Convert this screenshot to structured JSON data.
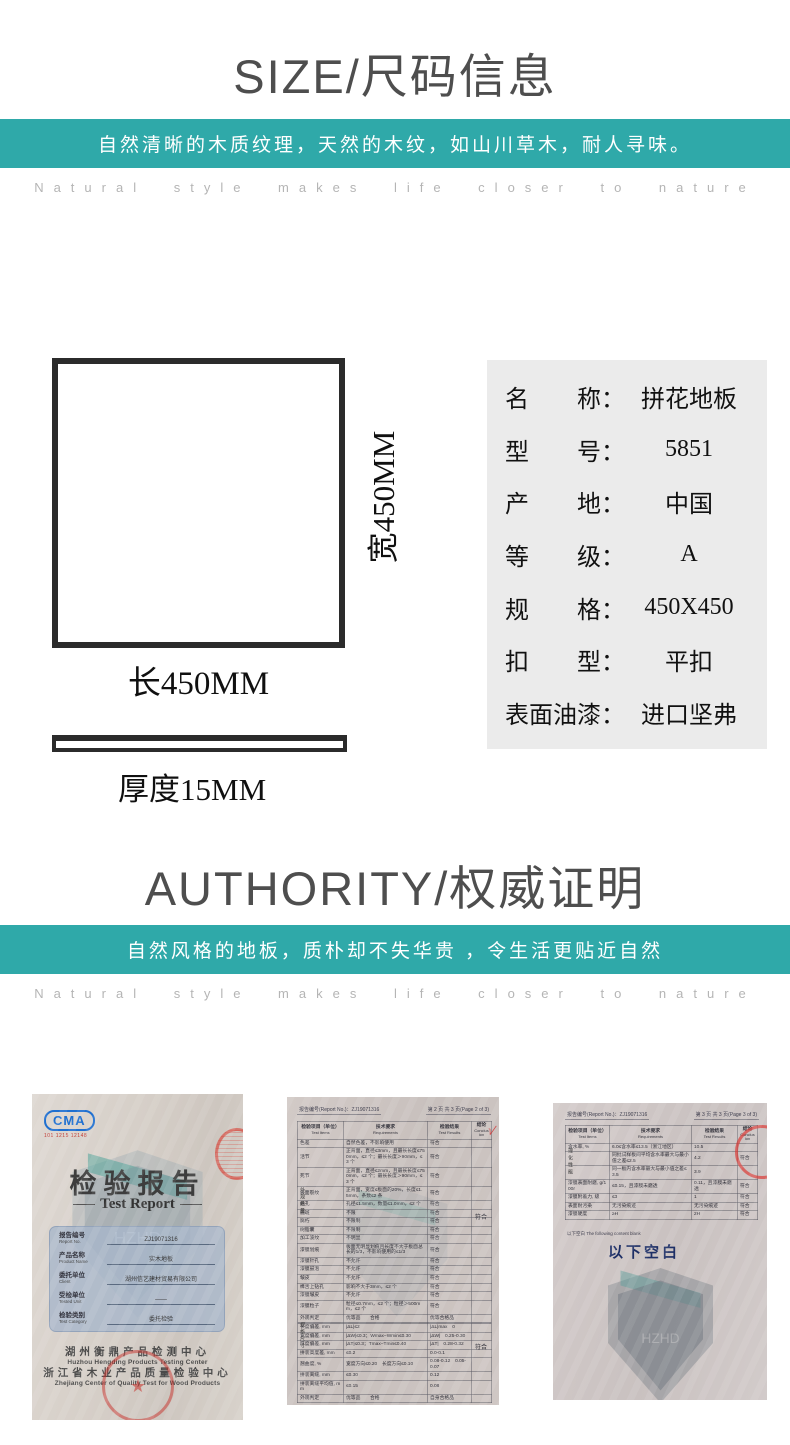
{
  "colors": {
    "accent_teal": "#2fa9a9",
    "paper": "#d2cac6",
    "cert_blue_box": "#a8b6ca"
  },
  "size_section": {
    "title": "SIZE/尺码信息",
    "banner_text": "自然清晰的木质纹理，天然的木纹，如山川草木，耐人寻味。",
    "subtitle": "Natural style makes life closer to nature"
  },
  "diagram": {
    "width_label": "宽450MM",
    "length_label": "长450MM",
    "thickness_label": "厚度15MM"
  },
  "specs": {
    "colon": "：",
    "rows": [
      {
        "label": "名　　称",
        "value": "拼花地板"
      },
      {
        "label": "型　　号",
        "value": "5851"
      },
      {
        "label": "产　　地",
        "value": "中国"
      },
      {
        "label": "等　　级",
        "value": "A"
      },
      {
        "label": "规　　格",
        "value": "450X450"
      },
      {
        "label": "扣　　型",
        "value": "平扣"
      },
      {
        "label": "表面油漆",
        "value": "进口坚弗"
      }
    ]
  },
  "authority_section": {
    "title": "AUTHORITY/权威证明",
    "banner_text": "自然风格的地板，质朴却不失华贵 ，令生活更贴近自然",
    "subtitle": "Natural style makes life closer to nature"
  },
  "certificates": {
    "table_headers": [
      {
        "cn": "检验项目（单位）",
        "en": "Test Items"
      },
      {
        "cn": "技术要求",
        "en": "Requirements"
      },
      {
        "cn": "检验结果",
        "en": "Test Results"
      },
      {
        "cn": "结论",
        "en": "Conclusion"
      }
    ],
    "cert1": {
      "cma_label": "CMA",
      "cma_sub": "101 1215 12148",
      "title": "检验报告",
      "subtitle": "Test Report",
      "watermark": "HZHD",
      "stamp_star": "★",
      "fields": [
        {
          "cn": "报告编号",
          "en": "Report No.",
          "value": "ZJ19071316"
        },
        {
          "cn": "产品名称",
          "en": "Product Name",
          "value": "实木地板"
        },
        {
          "cn": "委托单位",
          "en": "Client",
          "value": "湖州信艺建材贸易有限公司"
        },
        {
          "cn": "受检单位",
          "en": "Tested Unit",
          "value": "——"
        },
        {
          "cn": "检验类别",
          "en": "Test Category",
          "value": "委托检验"
        }
      ],
      "org_lines": [
        "湖州衡鼎产品检测中心",
        "Huzhou Hengding Products Testing Center",
        "浙江省木业产品质量检验中心",
        "Zhejiang Center of Quality Test for Wood Products"
      ]
    },
    "cert2": {
      "report_no": "报告编号(Report No.)：ZJ19071316",
      "page_info": "第 2 页 共 3 页(Page 2 of 3)",
      "group_a": "外观质量",
      "group_b": "规格尺寸",
      "mark": "√",
      "conclusion": "符合",
      "rows_a": [
        [
          "色差",
          "自然色差，不影响使用",
          "符合"
        ],
        [
          "活节",
          "正背面，直径≤3mm，且最长长度≤750mm，≤2 个；最长长度＞90mm，≤3 个",
          "符合"
        ],
        [
          "死节",
          "正背面，直径≤2mm，且最长长度≤750mm，≤2 个；最长长度＞90mm，≤3 个",
          "符合"
        ],
        [
          "表面裂纹",
          "正背面，宽度≤板面的20%，长度≤1.5mm，条数≤2 条",
          "符合"
        ],
        [
          "蛀孔",
          "孔径≤1.5mm，数量≤1.0mm，≤2 个",
          "符合"
        ],
        [
          "髓斑",
          "不限",
          "符合"
        ],
        [
          "腐朽",
          "不限制",
          "符合"
        ],
        [
          "树脂囊",
          "不限制",
          "符合"
        ],
        [
          "加工波纹",
          "不明显",
          "符合"
        ],
        [
          "漆膜划痕",
          "板面无明显划痕且长度不大于板面总长的1/3，不影响使用的≤1/3",
          "符合"
        ],
        [
          "漆膜针孔",
          "不允许",
          "符合"
        ],
        [
          "漆膜鼓泡",
          "不允许",
          "符合"
        ],
        [
          "皱皮",
          "不允许",
          "符合"
        ],
        [
          "榫舌上钻孔",
          "影响不大于3mm，≤2 个",
          "符合"
        ],
        [
          "漆膜皱皮",
          "不允许",
          "符合"
        ],
        [
          "漆膜粒子",
          "粒径≤0.7mm，≤2 个；粒径＞500mm，≤2 个",
          "符合"
        ],
        [
          "外观判定",
          "优等品　　合格",
          "优等合格品"
        ]
      ],
      "rows_b": [
        [
          "长度偏差, mm",
          "|ΔL|≤2",
          "|ΔL|max　0"
        ],
        [
          "宽度偏差, mm",
          "|ΔW|≤0.3；Wmax−Wmin≤0.30",
          "|ΔW|　0.25-0.30"
        ],
        [
          "厚度偏差, mm",
          "|ΔT|≤0.3；Tmax−Tmin≤0.40",
          "|ΔT|　0.28-0.32"
        ],
        [
          "拼装高度差, mm",
          "≤0.2",
          "0.0-0.1"
        ],
        [
          "翘曲度, %",
          "宽度方向≤0.20　长度方向≤0.10",
          "0.08-0.12　0.05-0.07"
        ],
        [
          "拼装离缝, mm",
          "≤0.30",
          "0.12"
        ],
        [
          "拼装离缝平均值, mm",
          "≤0.15",
          "0.08"
        ],
        [
          "外观判定",
          "优等品　　合格",
          "自身合格品"
        ]
      ]
    },
    "cert3": {
      "report_no": "报告编号(Report No.)：ZJ19071316",
      "page_info": "第 3 页 共 3 页(Page 3 of 3)",
      "group": "理化性能",
      "watermark": "HZHD",
      "note": "以下空白 The following content blank",
      "blank_label": "以下空白",
      "rows": [
        [
          "含水率, %",
          "6.0≤含水率≤13.5（浙江地区）",
          "10.5",
          ""
        ],
        [
          "",
          "同批试样板间平均含水率最大与最小值之差≤2.5",
          "4.2",
          "符合"
        ],
        [
          "",
          "同一板内含水率最大与最小值之差≤3.5",
          "3.9",
          ""
        ],
        [
          "漆膜表面耐磨, g/100r",
          "≤0.15，且漆膜未磨透",
          "0.11，且漆膜未磨透",
          "符合"
        ],
        [
          "漆膜附着力, 级",
          "≤3",
          "1",
          "符合"
        ],
        [
          "表面耐污染",
          "无污染痕迹",
          "无污染痕迹",
          "符合"
        ],
        [
          "漆膜硬度",
          "≥H",
          "2H",
          "符合"
        ]
      ]
    }
  }
}
